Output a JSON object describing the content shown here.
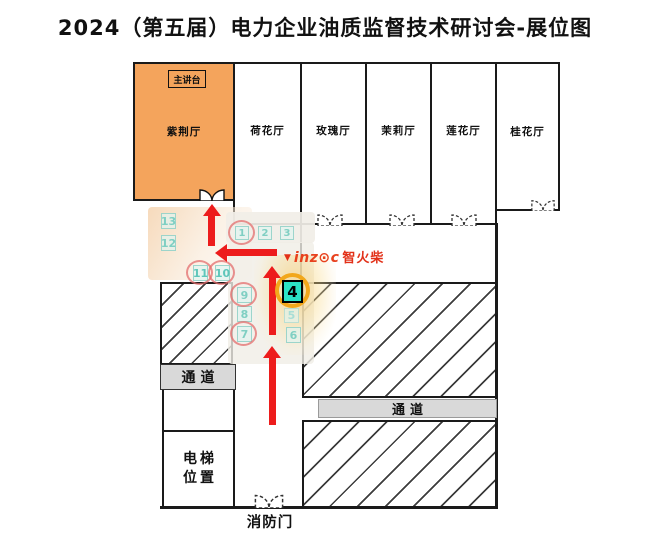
{
  "title": "2024（第五届）电力企业油质监督技术研讨会-展位图",
  "rooms": [
    {
      "id": "zijing",
      "label": "紫荆厅"
    },
    {
      "id": "hehua",
      "label": "荷花厅"
    },
    {
      "id": "meigui",
      "label": "玫瑰厅"
    },
    {
      "id": "moli",
      "label": "茉莉厅"
    },
    {
      "id": "lianhua",
      "label": "莲花厅"
    },
    {
      "id": "guihua",
      "label": "桂花厅"
    }
  ],
  "stage": {
    "label": "主讲台"
  },
  "booths": [
    {
      "label": "1",
      "circled": true,
      "highlighted": false
    },
    {
      "label": "2",
      "circled": false,
      "highlighted": false
    },
    {
      "label": "3",
      "circled": false,
      "highlighted": false
    },
    {
      "label": "4",
      "circled": false,
      "highlighted": true
    },
    {
      "label": "5",
      "circled": false,
      "highlighted": false
    },
    {
      "label": "6",
      "circled": false,
      "highlighted": false
    },
    {
      "label": "7",
      "circled": true,
      "highlighted": false
    },
    {
      "label": "8",
      "circled": false,
      "highlighted": false
    },
    {
      "label": "9",
      "circled": true,
      "highlighted": false
    },
    {
      "label": "10",
      "circled": true,
      "highlighted": false
    },
    {
      "label": "11",
      "circled": true,
      "highlighted": false
    },
    {
      "label": "12",
      "circled": false,
      "highlighted": false
    },
    {
      "label": "13",
      "circled": false,
      "highlighted": false
    }
  ],
  "logo": {
    "mark": "▼",
    "brand": "inz⊙c",
    "name": "智火柴"
  },
  "labels": {
    "corridor_left": "通道",
    "corridor_right": "通道",
    "elevator_line1": "电梯",
    "elevator_line2": "位置",
    "fire_door": "消防门"
  },
  "colors": {
    "room_highlight": "#F4A45C",
    "booth_highlight": "#2BE3C5",
    "booth_faded_text": "#7FCFC3",
    "highlight_ring": "#F2A71B",
    "route_arrow_red": "#ED1C1C",
    "corridor_gray": "#D9D9D9",
    "logo_red": "#E8411E"
  }
}
